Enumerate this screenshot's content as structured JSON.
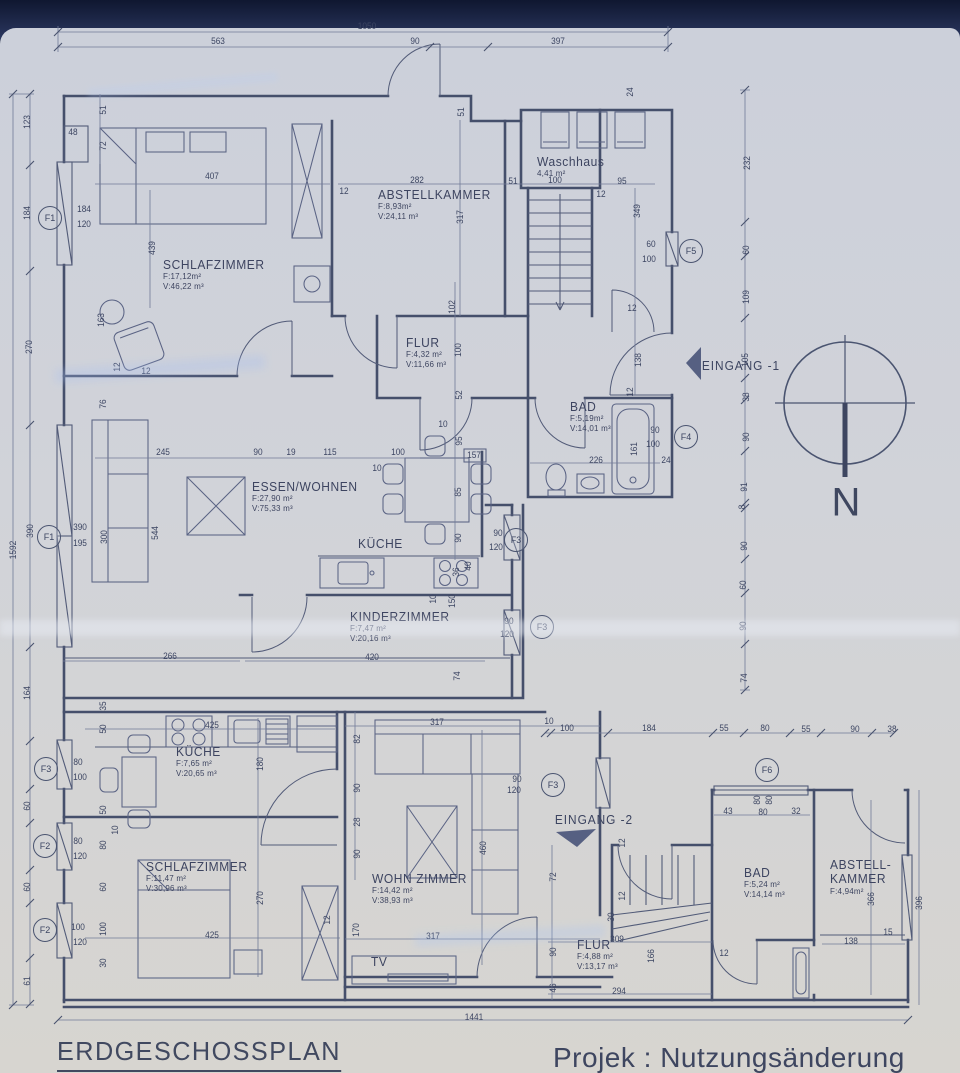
{
  "page": {
    "title": "ERDGESCHOSSPLAN",
    "project": "Projek : Nutzungsänderung",
    "north": "N",
    "paper_color": "#d1d3d9",
    "ink_color": "#454f6b",
    "accent_dark": "#141e3c"
  },
  "entrances": [
    {
      "label": "EINGANG -1",
      "x": 741,
      "y": 366
    },
    {
      "label": "EINGANG -2",
      "x": 594,
      "y": 820
    }
  ],
  "rooms": [
    {
      "n": [
        "SCHLAFZIMMER"
      ],
      "a": "F:17,12m²",
      "v": "V:46,22 m³",
      "x": 163,
      "y": 258
    },
    {
      "n": [
        "ABSTELLKAMMER"
      ],
      "a": "F:8,93m²",
      "v": "V:24,11 m³",
      "x": 378,
      "y": 188
    },
    {
      "n": [
        "Waschhaus"
      ],
      "a": "4,41 m²",
      "v": "",
      "x": 537,
      "y": 155
    },
    {
      "n": [
        "FLUR"
      ],
      "a": "F:4,32 m²",
      "v": "V:11,66 m³",
      "x": 406,
      "y": 336
    },
    {
      "n": [
        "BAD"
      ],
      "a": "F:5,19m²",
      "v": "V:14,01 m³",
      "x": 570,
      "y": 400
    },
    {
      "n": [
        "ESSEN/WOHNEN"
      ],
      "a": "F:27,90 m²",
      "v": "V:75,33 m³",
      "x": 252,
      "y": 480
    },
    {
      "n": [
        "KÜCHE"
      ],
      "a": "",
      "v": "",
      "x": 358,
      "y": 537
    },
    {
      "n": [
        "KINDERZIMMER"
      ],
      "a": "F:7,47 m²",
      "v": "V:20,16 m³",
      "x": 350,
      "y": 610
    },
    {
      "n": [
        "KÜCHE"
      ],
      "a": "F:7,65 m²",
      "v": "V:20,65 m³",
      "x": 176,
      "y": 745
    },
    {
      "n": [
        "SCHLAFZIMMER"
      ],
      "a": "F:11,47 m²",
      "v": "V:30,96 m³",
      "x": 146,
      "y": 860
    },
    {
      "n": [
        "WOHN ZIMMER"
      ],
      "a": "F:14,42 m²",
      "v": "V:38,93 m³",
      "x": 372,
      "y": 872
    },
    {
      "n": [
        "FLUR"
      ],
      "a": "F:4,88 m²",
      "v": "V:13,17 m³",
      "x": 577,
      "y": 938
    },
    {
      "n": [
        "BAD"
      ],
      "a": "F:5,24 m²",
      "v": "V:14,14 m³",
      "x": 744,
      "y": 866
    },
    {
      "n": [
        "ABSTELL-",
        "KAMMER"
      ],
      "a": "F:4,94m²",
      "v": "",
      "x": 830,
      "y": 858
    },
    {
      "n": [
        "TV"
      ],
      "a": "",
      "v": "",
      "x": 371,
      "y": 955
    }
  ],
  "window_tags": [
    {
      "label": "F1",
      "x": 50,
      "y": 218
    },
    {
      "label": "F1",
      "x": 49,
      "y": 537
    },
    {
      "label": "F3",
      "x": 46,
      "y": 769
    },
    {
      "label": "F2",
      "x": 45,
      "y": 846
    },
    {
      "label": "F2",
      "x": 45,
      "y": 930
    },
    {
      "label": "F5",
      "x": 691,
      "y": 251
    },
    {
      "label": "F4",
      "x": 686,
      "y": 437
    },
    {
      "label": "F3",
      "x": 516,
      "y": 540
    },
    {
      "label": "F3",
      "x": 542,
      "y": 627
    },
    {
      "label": "F3",
      "x": 553,
      "y": 785
    },
    {
      "label": "F6",
      "x": 767,
      "y": 770
    }
  ],
  "dim_labels": [
    {
      "t": "1050",
      "x": 367,
      "y": 26
    },
    {
      "t": "563",
      "x": 218,
      "y": 41
    },
    {
      "t": "90",
      "x": 415,
      "y": 41
    },
    {
      "t": "397",
      "x": 558,
      "y": 41
    },
    {
      "t": "123",
      "x": 27,
      "y": 122,
      "r": 1
    },
    {
      "t": "184",
      "x": 27,
      "y": 213,
      "r": 1
    },
    {
      "t": "270",
      "x": 29,
      "y": 347,
      "r": 1
    },
    {
      "t": "1592",
      "x": 13,
      "y": 550,
      "r": 1
    },
    {
      "t": "390",
      "x": 30,
      "y": 531,
      "r": 1
    },
    {
      "t": "164",
      "x": 27,
      "y": 693,
      "r": 1
    },
    {
      "t": "60",
      "x": 27,
      "y": 806,
      "r": 1
    },
    {
      "t": "60",
      "x": 27,
      "y": 887,
      "r": 1
    },
    {
      "t": "61",
      "x": 27,
      "y": 981,
      "r": 1
    },
    {
      "t": "184",
      "x": 84,
      "y": 209
    },
    {
      "t": "120",
      "x": 84,
      "y": 224
    },
    {
      "t": "390",
      "x": 80,
      "y": 527
    },
    {
      "t": "195",
      "x": 80,
      "y": 543
    },
    {
      "t": "80",
      "x": 78,
      "y": 762
    },
    {
      "t": "100",
      "x": 80,
      "y": 777
    },
    {
      "t": "80",
      "x": 78,
      "y": 841
    },
    {
      "t": "120",
      "x": 80,
      "y": 856
    },
    {
      "t": "100",
      "x": 78,
      "y": 927
    },
    {
      "t": "120",
      "x": 80,
      "y": 942
    },
    {
      "t": "48",
      "x": 73,
      "y": 132
    },
    {
      "t": "51",
      "x": 103,
      "y": 110,
      "r": 1
    },
    {
      "t": "72",
      "x": 103,
      "y": 146,
      "r": 1
    },
    {
      "t": "439",
      "x": 152,
      "y": 248,
      "r": 1
    },
    {
      "t": "407",
      "x": 212,
      "y": 176
    },
    {
      "t": "163",
      "x": 101,
      "y": 320,
      "r": 1
    },
    {
      "t": "12",
      "x": 117,
      "y": 367,
      "r": 1
    },
    {
      "t": "12",
      "x": 146,
      "y": 371
    },
    {
      "t": "76",
      "x": 103,
      "y": 404,
      "r": 1
    },
    {
      "t": "245",
      "x": 163,
      "y": 452
    },
    {
      "t": "90",
      "x": 258,
      "y": 452
    },
    {
      "t": "19",
      "x": 291,
      "y": 452
    },
    {
      "t": "115",
      "x": 330,
      "y": 452
    },
    {
      "t": "100",
      "x": 398,
      "y": 452
    },
    {
      "t": "10",
      "x": 377,
      "y": 468
    },
    {
      "t": "157",
      "x": 474,
      "y": 455
    },
    {
      "t": "300",
      "x": 104,
      "y": 537,
      "r": 1
    },
    {
      "t": "544",
      "x": 155,
      "y": 533,
      "r": 1
    },
    {
      "t": "95",
      "x": 459,
      "y": 441,
      "r": 1
    },
    {
      "t": "85",
      "x": 458,
      "y": 492,
      "r": 1
    },
    {
      "t": "90",
      "x": 458,
      "y": 538,
      "r": 1
    },
    {
      "t": "36",
      "x": 456,
      "y": 572,
      "r": 1
    },
    {
      "t": "40",
      "x": 468,
      "y": 566,
      "r": 1
    },
    {
      "t": "10",
      "x": 433,
      "y": 599,
      "r": 1
    },
    {
      "t": "150",
      "x": 452,
      "y": 601,
      "r": 1
    },
    {
      "t": "282",
      "x": 417,
      "y": 180
    },
    {
      "t": "12",
      "x": 344,
      "y": 191
    },
    {
      "t": "317",
      "x": 460,
      "y": 217,
      "r": 1
    },
    {
      "t": "102",
      "x": 452,
      "y": 307,
      "r": 1
    },
    {
      "t": "51",
      "x": 461,
      "y": 112,
      "r": 1
    },
    {
      "t": "24",
      "x": 630,
      "y": 92,
      "r": 1
    },
    {
      "t": "51",
      "x": 513,
      "y": 181
    },
    {
      "t": "100",
      "x": 555,
      "y": 180
    },
    {
      "t": "95",
      "x": 622,
      "y": 181
    },
    {
      "t": "12",
      "x": 601,
      "y": 194
    },
    {
      "t": "349",
      "x": 637,
      "y": 211,
      "r": 1
    },
    {
      "t": "100",
      "x": 458,
      "y": 350,
      "r": 1
    },
    {
      "t": "52",
      "x": 459,
      "y": 395,
      "r": 1
    },
    {
      "t": "10",
      "x": 443,
      "y": 424
    },
    {
      "t": "12",
      "x": 632,
      "y": 308
    },
    {
      "t": "138",
      "x": 638,
      "y": 360,
      "r": 1
    },
    {
      "t": "12",
      "x": 630,
      "y": 392,
      "r": 1
    },
    {
      "t": "226",
      "x": 596,
      "y": 460
    },
    {
      "t": "161",
      "x": 634,
      "y": 449,
      "r": 1
    },
    {
      "t": "90",
      "x": 655,
      "y": 430
    },
    {
      "t": "100",
      "x": 653,
      "y": 444
    },
    {
      "t": "24",
      "x": 666,
      "y": 460
    },
    {
      "t": "60",
      "x": 651,
      "y": 244
    },
    {
      "t": "100",
      "x": 649,
      "y": 259
    },
    {
      "t": "232",
      "x": 747,
      "y": 163,
      "r": 1
    },
    {
      "t": "60",
      "x": 746,
      "y": 250,
      "r": 1
    },
    {
      "t": "109",
      "x": 746,
      "y": 297,
      "r": 1
    },
    {
      "t": "105",
      "x": 745,
      "y": 360,
      "r": 1
    },
    {
      "t": "38",
      "x": 746,
      "y": 397,
      "r": 1
    },
    {
      "t": "90",
      "x": 746,
      "y": 437,
      "r": 1
    },
    {
      "t": "91",
      "x": 744,
      "y": 487,
      "r": 1
    },
    {
      "t": "8",
      "x": 742,
      "y": 507,
      "r": 1
    },
    {
      "t": "90",
      "x": 744,
      "y": 546,
      "r": 1
    },
    {
      "t": "60",
      "x": 743,
      "y": 585,
      "r": 1
    },
    {
      "t": "90",
      "x": 743,
      "y": 626,
      "r": 1
    },
    {
      "t": "74",
      "x": 744,
      "y": 678,
      "r": 1
    },
    {
      "t": "420",
      "x": 372,
      "y": 657
    },
    {
      "t": "266",
      "x": 170,
      "y": 656
    },
    {
      "t": "74",
      "x": 457,
      "y": 676,
      "r": 1
    },
    {
      "t": "90",
      "x": 509,
      "y": 621
    },
    {
      "t": "120",
      "x": 507,
      "y": 634
    },
    {
      "t": "90",
      "x": 498,
      "y": 533
    },
    {
      "t": "120",
      "x": 496,
      "y": 547
    },
    {
      "t": "10",
      "x": 549,
      "y": 721
    },
    {
      "t": "100",
      "x": 567,
      "y": 728
    },
    {
      "t": "184",
      "x": 649,
      "y": 728
    },
    {
      "t": "55",
      "x": 724,
      "y": 728
    },
    {
      "t": "80",
      "x": 765,
      "y": 728
    },
    {
      "t": "55",
      "x": 806,
      "y": 729
    },
    {
      "t": "90",
      "x": 855,
      "y": 729
    },
    {
      "t": "38",
      "x": 892,
      "y": 729
    },
    {
      "t": "80",
      "x": 757,
      "y": 800,
      "r": 1
    },
    {
      "t": "80",
      "x": 769,
      "y": 800,
      "r": 1
    },
    {
      "t": "43",
      "x": 728,
      "y": 811
    },
    {
      "t": "80",
      "x": 763,
      "y": 812
    },
    {
      "t": "32",
      "x": 796,
      "y": 811
    },
    {
      "t": "425",
      "x": 212,
      "y": 725
    },
    {
      "t": "180",
      "x": 260,
      "y": 764,
      "r": 1
    },
    {
      "t": "35",
      "x": 103,
      "y": 706,
      "r": 1
    },
    {
      "t": "50",
      "x": 103,
      "y": 729,
      "r": 1
    },
    {
      "t": "50",
      "x": 103,
      "y": 810,
      "r": 1
    },
    {
      "t": "10",
      "x": 115,
      "y": 830,
      "r": 1
    },
    {
      "t": "80",
      "x": 103,
      "y": 845,
      "r": 1
    },
    {
      "t": "60",
      "x": 103,
      "y": 887,
      "r": 1
    },
    {
      "t": "100",
      "x": 103,
      "y": 929,
      "r": 1
    },
    {
      "t": "30",
      "x": 103,
      "y": 963,
      "r": 1
    },
    {
      "t": "82",
      "x": 357,
      "y": 739,
      "r": 1
    },
    {
      "t": "90",
      "x": 357,
      "y": 788,
      "r": 1
    },
    {
      "t": "28",
      "x": 357,
      "y": 822,
      "r": 1
    },
    {
      "t": "90",
      "x": 357,
      "y": 854,
      "r": 1
    },
    {
      "t": "270",
      "x": 260,
      "y": 898,
      "r": 1
    },
    {
      "t": "425",
      "x": 212,
      "y": 935
    },
    {
      "t": "170",
      "x": 356,
      "y": 930,
      "r": 1
    },
    {
      "t": "12",
      "x": 327,
      "y": 920,
      "r": 1
    },
    {
      "t": "317",
      "x": 437,
      "y": 722
    },
    {
      "t": "460",
      "x": 483,
      "y": 848,
      "r": 1
    },
    {
      "t": "317",
      "x": 433,
      "y": 936
    },
    {
      "t": "90",
      "x": 517,
      "y": 779
    },
    {
      "t": "120",
      "x": 514,
      "y": 790
    },
    {
      "t": "12",
      "x": 622,
      "y": 843,
      "r": 1
    },
    {
      "t": "12",
      "x": 622,
      "y": 896,
      "r": 1
    },
    {
      "t": "30",
      "x": 611,
      "y": 917,
      "r": 1
    },
    {
      "t": "309",
      "x": 617,
      "y": 939
    },
    {
      "t": "166",
      "x": 651,
      "y": 956,
      "r": 1
    },
    {
      "t": "294",
      "x": 619,
      "y": 991
    },
    {
      "t": "12",
      "x": 724,
      "y": 953
    },
    {
      "t": "72",
      "x": 553,
      "y": 877,
      "r": 1
    },
    {
      "t": "90",
      "x": 553,
      "y": 952,
      "r": 1
    },
    {
      "t": "46",
      "x": 553,
      "y": 988,
      "r": 1
    },
    {
      "t": "366",
      "x": 871,
      "y": 899,
      "r": 1
    },
    {
      "t": "396",
      "x": 919,
      "y": 903,
      "r": 1
    },
    {
      "t": "138",
      "x": 851,
      "y": 941
    },
    {
      "t": "15",
      "x": 888,
      "y": 932
    },
    {
      "t": "1441",
      "x": 474,
      "y": 1017
    }
  ]
}
